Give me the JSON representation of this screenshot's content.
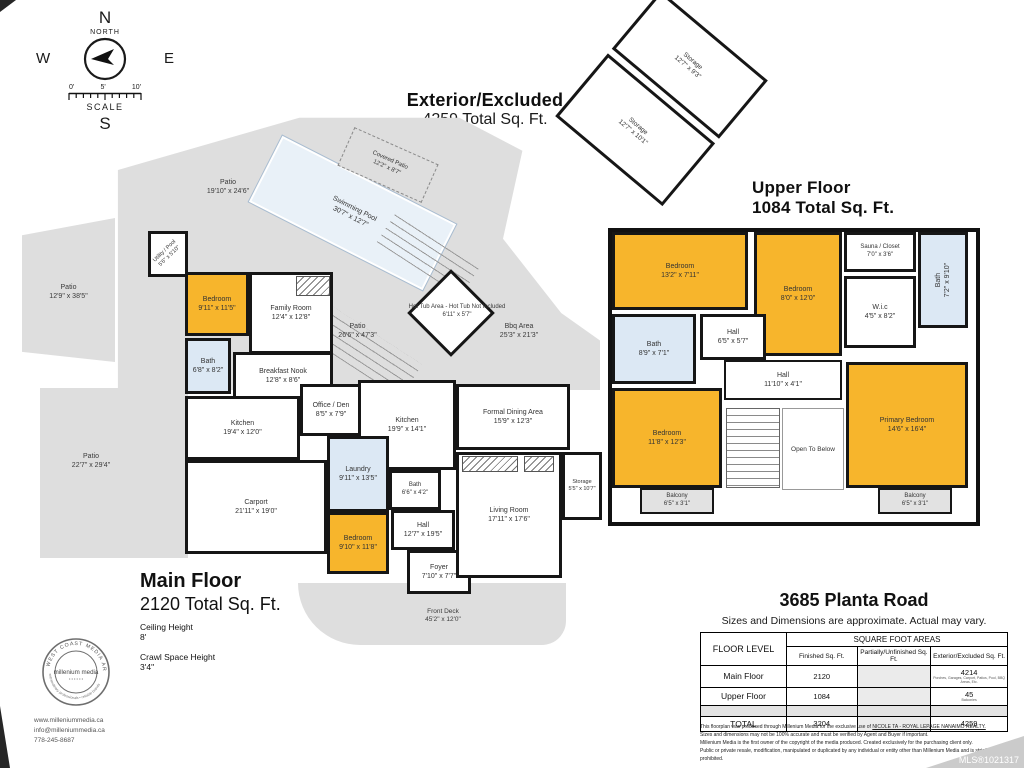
{
  "colors": {
    "room_yellow": "#F7B52C",
    "room_blue": "#DCE8F4",
    "patio_gray": "#DEDEDE",
    "pool_blue": "#E9F1F8",
    "wall_black": "#161616"
  },
  "compass": {
    "n": "N",
    "e": "E",
    "s": "S",
    "w": "W",
    "north_label": "NORTH",
    "scale_label": "SCALE",
    "ticks": [
      "0'",
      "5'",
      "10'"
    ]
  },
  "exterior_block": {
    "title": "Exterior/Excluded",
    "subtitle": "4259 Total Sq. Ft."
  },
  "storage_wing": {
    "storage1": {
      "name": "Storage",
      "dims": "12'7\" x 9'3\""
    },
    "storage2": {
      "name": "Storage",
      "dims": "12'7\" x 10'1\""
    }
  },
  "upper_floor": {
    "title": "Upper Floor",
    "subtitle": "1084 Total Sq. Ft.",
    "rooms": {
      "bedroom1": {
        "name": "Bedroom",
        "dims": "13'2\" x 7'11\""
      },
      "bedroom2": {
        "name": "Bedroom",
        "dims": "8'0\" x 12'0\""
      },
      "sauna": {
        "name": "Sauna / Closet",
        "dims": "7'0\" x 3'6\""
      },
      "bath_ensuite": {
        "name": "Bath",
        "dims": "7'2\" x 9'10\""
      },
      "wic": {
        "name": "W.i.c",
        "dims": "4'5\" x 8'2\""
      },
      "bath": {
        "name": "Bath",
        "dims": "8'9\" x 7'1\""
      },
      "hall_small": {
        "name": "Hall",
        "dims": "6'5\" x 5'7\""
      },
      "hall_long": {
        "name": "Hall",
        "dims": "11'10\" x 4'1\""
      },
      "bedroom3": {
        "name": "Bedroom",
        "dims": "11'8\" x 12'3\""
      },
      "open_below": {
        "label": "Open To Below"
      },
      "primary": {
        "name": "Primary Bedroom",
        "dims": "14'6\" x 16'4\""
      },
      "balcony1": {
        "name": "Balcony",
        "dims": "6'5\" x 3'1\""
      },
      "balcony2": {
        "name": "Balcony",
        "dims": "6'5\" x 3'1\""
      }
    }
  },
  "main_floor": {
    "title": "Main Floor",
    "subtitle": "2120 Total Sq. Ft.",
    "ceiling_label": "Ceiling Height",
    "ceiling_value": "8'",
    "crawl_label": "Crawl Space Height",
    "crawl_value": "3'4\"",
    "rooms": {
      "covered_patio": {
        "name": "Covered Patio",
        "dims": "12'2\" x 8'7\""
      },
      "patio_top": {
        "name": "Patio",
        "dims": "19'10\" x 24'6\""
      },
      "pool": {
        "name": "Swimming Pool",
        "dims": "30'7\" x 12'7\""
      },
      "utility": {
        "name": "Utility / Pool",
        "dims": "5'6\" x 5'10\""
      },
      "patio_left": {
        "name": "Patio",
        "dims": "12'9\" x 38'5\""
      },
      "bedroom_a": {
        "name": "Bedroom",
        "dims": "9'11\" x 11'5\""
      },
      "family": {
        "name": "Family Room",
        "dims": "12'4\" x 12'8\""
      },
      "bath_a": {
        "name": "Bath",
        "dims": "6'8\" x 8'2\""
      },
      "nook": {
        "name": "Breakfast Nook",
        "dims": "12'8\" x 8'6\""
      },
      "kitchen_a": {
        "name": "Kitchen",
        "dims": "19'4\" x 12'0\""
      },
      "office": {
        "name": "Office / Den",
        "dims": "8'5\" x 7'9\""
      },
      "kitchen_b": {
        "name": "Kitchen",
        "dims": "19'9\" x 14'1\""
      },
      "dining": {
        "name": "Formal Dining Area",
        "dims": "15'9\" x 12'3\""
      },
      "patio_center": {
        "name": "Patio",
        "dims": "26'6\" x 47'3\""
      },
      "hot_tub": {
        "name": "Hot Tub Area - Hot Tub Not Included",
        "dims": "6'11\" x 5'7\""
      },
      "bbq": {
        "name": "Bbq Area",
        "dims": "25'3\" x 21'3\""
      },
      "patio_bl": {
        "name": "Patio",
        "dims": "22'7\" x 29'4\""
      },
      "carport": {
        "name": "Carport",
        "dims": "21'11\" x 19'0\""
      },
      "laundry": {
        "name": "Laundry",
        "dims": "9'11\" x 13'5\""
      },
      "bath_b": {
        "name": "Bath",
        "dims": "6'6\" x 4'2\""
      },
      "bedroom_b": {
        "name": "Bedroom",
        "dims": "9'10\" x 11'8\""
      },
      "hall": {
        "name": "Hall",
        "dims": "12'7\" x 19'5\""
      },
      "foyer": {
        "name": "Foyer",
        "dims": "7'10\" x 7'7\""
      },
      "living": {
        "name": "Living Room",
        "dims": "17'11\" x 17'6\""
      },
      "storage": {
        "name": "Storage",
        "dims": "5'5\" x 10'7\""
      },
      "front_deck": {
        "name": "Front Deck",
        "dims": "45'2\" x 12'0\""
      }
    }
  },
  "address": {
    "title": "3685 Planta Road",
    "subtitle": "Sizes and Dimensions are approximate. Actual may vary.",
    "table": {
      "floor_col": "FLOOR LEVEL",
      "span_header": "SQUARE FOOT AREAS",
      "columns": [
        "Finished Sq. Ft.",
        "Partially/Unfinished Sq. Ft.",
        "Exterior/Excluded Sq. Ft."
      ],
      "rows": [
        {
          "level": "Main Floor",
          "finished": "2120",
          "exterior": "4214",
          "note": "Porches, Garages, Carport, Patios, Pool, BBQ Areas, Etc."
        },
        {
          "level": "Upper Floor",
          "finished": "1084",
          "exterior": "45",
          "note": "Balconies"
        },
        {
          "level": "TOTAL",
          "finished": "3204",
          "exterior": "4259",
          "note": ""
        }
      ]
    }
  },
  "footer": {
    "stamp": {
      "ring_top": "WEST COAST MEDIA ARTS",
      "ring_bottom": "extraordinary professionals • reliable brands",
      "center": "millenium media"
    },
    "website": "www.milleniummedia.ca",
    "email": "info@milleniummedia.ca",
    "phone": "778-245-8687",
    "disclaimer": {
      "l1a": "This floorplan was produced through Millenium Media for the exclusive use of ",
      "l1b": "NICOLE TA - ROYAL LEPAGE NANAIMO REALTY.",
      "l2": "Sizes and dimensions may not be 100% accurate and must be verified by Agent and Buyer if important.",
      "l3": "Millenium Media is the first owner of the copyright of the media produced. Created exclusively for the purchasing client only.",
      "l4": "Public or private resale, modification, manipulated or duplicated by any individual or entity other than Millenium Media and is strictly prohibited."
    },
    "mls": "MLS®1021317"
  }
}
